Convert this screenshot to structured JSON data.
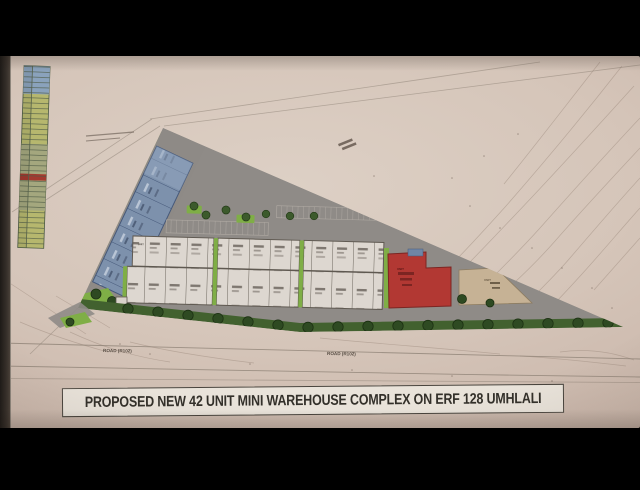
{
  "title_block": {
    "text": "PROPOSED NEW 42 UNIT MINI WAREHOUSE COMPLEX ON ERF 128 UMHLALI"
  },
  "road_labels": [
    "ROAD (R102)",
    "ROAD (R102)"
  ],
  "units": {
    "label_prefix": "UNIT"
  },
  "colors": {
    "paper": "#d5c5b9",
    "road_gray": "#8f8b87",
    "blue_units": "#7d91ac",
    "yellow_units": "#b9bb72",
    "white_units": "#ddd7d0",
    "red_building": "#b23833",
    "beige_area": "#c6b295",
    "landscape_green": "#7fae46",
    "hedge_green": "#42612f",
    "legend_red_row": "#a33a30"
  }
}
